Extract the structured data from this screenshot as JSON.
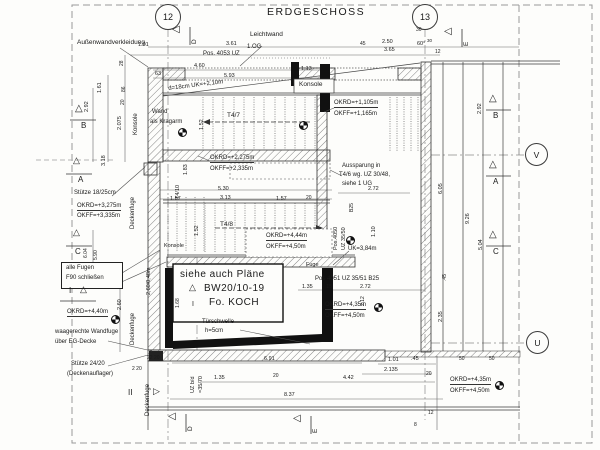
{
  "title": "ERDGESCHOSS",
  "bubbles": {
    "n12": "12",
    "n13": "13",
    "v": "V",
    "u": "U"
  },
  "marks": {
    "b": "B",
    "a": "A",
    "c": "C",
    "i": "I",
    "ii": "II",
    "d": "D",
    "e": "E"
  },
  "icons": {
    "tri_left": "◁",
    "tri_right": "▷",
    "tri_up": "△"
  },
  "labels": {
    "aussenwand": "Außenwandverkleidung",
    "leichtwand": "Leichtwand",
    "og": "1.OG",
    "pos4053": "Pos. 4053 UZ",
    "d18": "d=18cm  UK=+2,10m",
    "konsole": "Konsole",
    "wand1": "Wand",
    "wand2": "als Kragarm",
    "auss1": "Aussparung in",
    "auss2": "T4/6 wg. UZ 30/48,",
    "auss3": "siehe 1 UG",
    "stuetze18": "Stütze 18/25cm",
    "deckenfuge": "Deckenfuge",
    "pos4050a": "Pos.4050",
    "pos4050b": "UZ 35/50",
    "b25": "B25",
    "uk384": "UK=3,84m",
    "pos4051": "Pos 4051 UZ 35/51 B25",
    "fuge": "Fuge",
    "allefugen1": "alle Fugen",
    "allefugen2": "F90 schließen",
    "waag1": "waagerechte Wandfuge",
    "waag2": "über EG-Decke",
    "stuetze24": "Stütze 24/20",
    "auflager": "(Deckenauflager)",
    "siehe1": "siehe auch Pläne",
    "siehe2": "BW20/10-19",
    "siehe3": "Fo. KOCH",
    "tuer1": "Türschwelle",
    "tuer2": "h=5cm",
    "uzbd1": "UZ b/d",
    "uzbd2": "=35/70",
    "fm260": "2,60/0,48m"
  },
  "stairs": {
    "t47": "T4/7",
    "t48": "T4/8",
    "t410": "T4/10"
  },
  "levels": {
    "okrd1105": "OKRD=+1,105m",
    "okff1165": "OKFF=+1,165m",
    "okrd2275": "OKRD=+2,275m",
    "okff2335": "OKFF=+2,335m",
    "okrd3275": "OKRD=+3,275m",
    "okff3335": "OKFF=+3,335m",
    "okrd444": "OKRD=+4,44m",
    "okff450": "OKFF=+4,50m",
    "okrd435": "OKRD=+4,35m",
    "okrd440": "OKRD=+4,40m"
  },
  "dims": {
    "d101": "1.01",
    "d361": "3.61",
    "d250": "2.50",
    "d365": "3.65",
    "d45g": "45",
    "d30": "30",
    "d60": "60°",
    "d12": "12",
    "d460": "4.60",
    "d63": "63",
    "d593": "5.93",
    "d113": "1.13",
    "d152": "1.52",
    "d292": "2.92",
    "d2075": "2.075",
    "d161": "1.61",
    "d28": "28",
    "d86": "86",
    "d20": "20",
    "d318": "3.18",
    "d272": "2.72",
    "d530": "5.30",
    "d313": "3.13",
    "d157": "1.57",
    "d183": "1.83",
    "d110": "1.10",
    "d135": "1.35",
    "d15": ".15",
    "d691": "6.91",
    "d837": "8.37",
    "d442": "4.42",
    "d2135": "2.135",
    "d45": ".45",
    "d605": "6.05",
    "d926": "9.26",
    "d504": "5.04",
    "d235": "2.35",
    "d604": "6.04",
    "d590": "5.90",
    "d260": "2.60",
    "d168": "1.68",
    "d212": "2.12",
    "d8": "8",
    "d50": "50",
    "d2220": "22 20",
    "d220": "2 20"
  }
}
